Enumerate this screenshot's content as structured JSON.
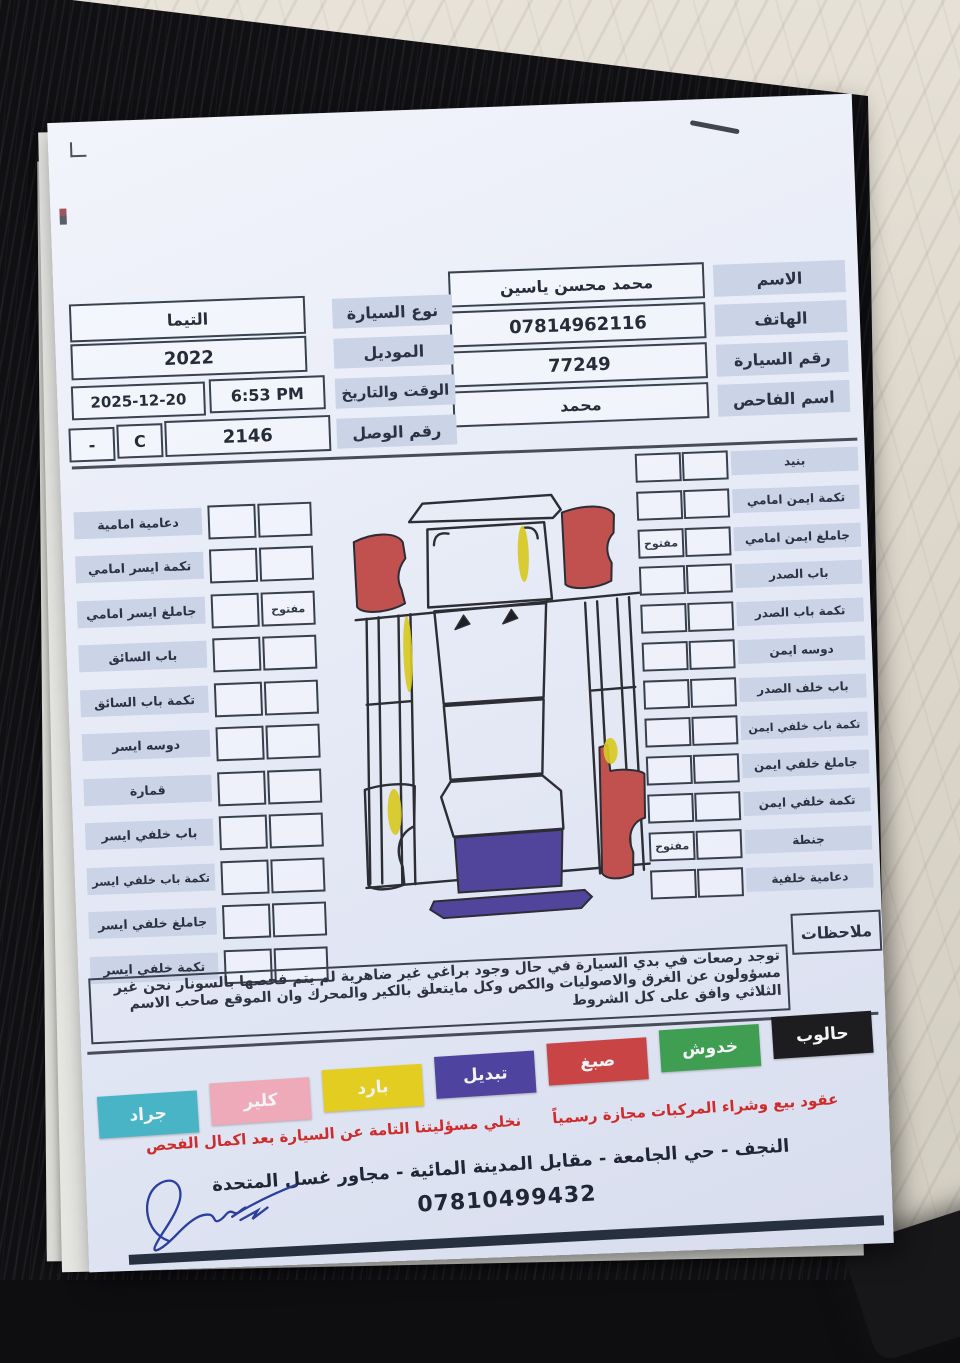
{
  "header": {
    "right_fields": [
      {
        "label": "الاسم",
        "value": "محمد محسن ياسين"
      },
      {
        "label": "الهاتف",
        "value": "07814962116"
      },
      {
        "label": "رقم السيارة",
        "value": "77249"
      },
      {
        "label": "اسم الفاحص",
        "value": "محمد"
      }
    ],
    "car_type_label": "نوع السيارة",
    "car_type": "التيما",
    "model_label": "الموديل",
    "model": "2022",
    "datetime_label": "الوقت والتاريخ",
    "time": "6:53 PM",
    "date": "2025-12-20",
    "receipt_label": "رقم الوصل",
    "receipt_number": "2146",
    "receipt_code": "C",
    "receipt_dash": "-"
  },
  "checklist": {
    "open_label": "مفتوح",
    "left": [
      {
        "label": "دعامية امامية"
      },
      {
        "label": "تكمة ايسر امامي"
      },
      {
        "label": "جاملغ ايسر امامي",
        "status": "مفتوح"
      },
      {
        "label": "باب السائق"
      },
      {
        "label": "تكمة باب السائق"
      },
      {
        "label": "دوسه ايسر"
      },
      {
        "label": "قمارة"
      },
      {
        "label": "باب خلفي ايسر"
      },
      {
        "label": "تكمة باب خلفي ايسر"
      },
      {
        "label": "جاملغ خلفي ايسر"
      },
      {
        "label": "تكمة خلفي ايسر"
      }
    ],
    "right": [
      {
        "label": "بنيد"
      },
      {
        "label": "تكمة ايمن امامي"
      },
      {
        "label": "جاملغ ايمن امامي",
        "status": "مفتوح"
      },
      {
        "label": "باب الصدر"
      },
      {
        "label": "تكمة باب الصدر"
      },
      {
        "label": "دوسه ايمن"
      },
      {
        "label": "باب خلف الصدر"
      },
      {
        "label": "تكمة باب خلفي ايمن"
      },
      {
        "label": "جاملغ خلفي ايمن"
      },
      {
        "label": "تكمة خلفي ايمن"
      },
      {
        "label": "جنطة",
        "status": "مفتوح"
      },
      {
        "label": "دعامية خلفية"
      }
    ]
  },
  "notes": {
    "label": "ملاحظات",
    "text": "توجد رصعات في بدي السيارة في حال وجود براغي غير ضاهرية لم يتم فحصها بالسونار نحن غير مسؤولون عن الغرق والاصوليات والكص وكل مايتعلق بالكير والمحرك وان الموقع صاحب الاسم الثلاثي وافق على كل الشروط"
  },
  "legend": [
    {
      "label": "جراد",
      "color": "#49b4c5"
    },
    {
      "label": "كلير",
      "color": "#eeaab8"
    },
    {
      "label": "بارد",
      "color": "#e2cd20"
    },
    {
      "label": "تبديل",
      "color": "#4f43a0"
    },
    {
      "label": "صبغ",
      "color": "#c94444"
    },
    {
      "label": "خدوش",
      "color": "#3f9e52"
    },
    {
      "label": "حالوب",
      "color": "#1d1d20"
    }
  ],
  "footer": {
    "disclaimer": "عقود بيع وشراء المركبات مجازة رسمياً      نخلي مسؤليتنا التامة عن السيارة بعد اكمال الفحص",
    "address": "النجف - حي الجامعة - مقابل المدينة المائية - مجاور غسل المتحدة",
    "phone": "07810499432"
  },
  "diagram_colors": {
    "paint_red": "#c0514f",
    "replace_purple": "#50449b",
    "cold_yellow": "#d8c922"
  }
}
